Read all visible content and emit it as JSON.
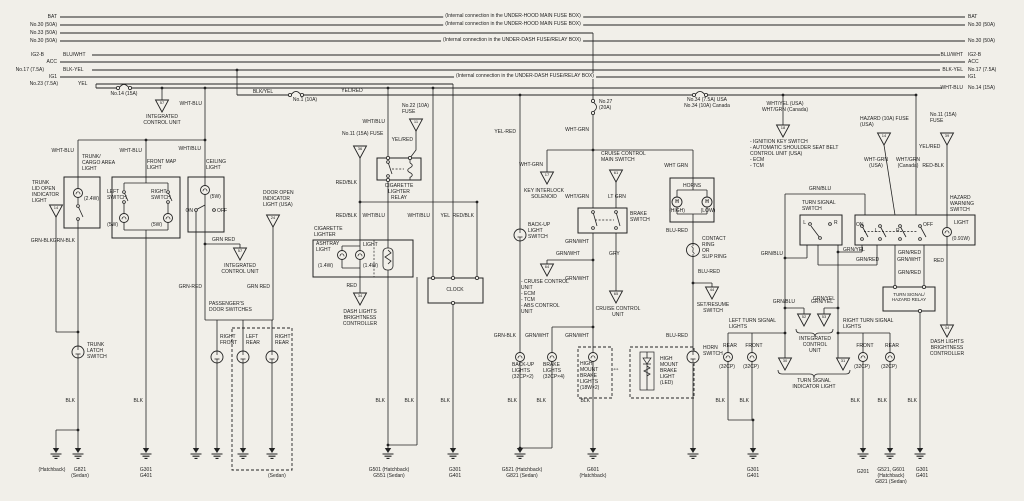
{
  "page": {
    "background_color": "#f1efe9",
    "line_color": "#232323"
  },
  "bus_left": {
    "bat": "BAT",
    "no30a": "No.30 (50A)",
    "no33": "No.33 (50A)",
    "no30b": "No.30 (50A)",
    "ig2b": "IG2-B",
    "ig2b_color": "BLU/WHT",
    "acc": "ACC",
    "no17": "No.17 (7.5A)",
    "no17_color": "BLK-YEL",
    "ig1": "IG1",
    "no23": "No.23 (7.5A)",
    "no23_color": "YEL"
  },
  "bus_right": {
    "bat": "BAT",
    "no30a": "No.30 (50A)",
    "no30b": "No.30 (50A)",
    "ig2b_color": "BLU/WHT",
    "ig2b": "IG2-B",
    "acc": "ACC",
    "no17_color": "BLK-YEL",
    "no17": "No.17 (7.5A)",
    "ig1": "IG1",
    "no14_color": "WHT-BLU",
    "no14": "No.14 (15A)"
  },
  "notes": {
    "underhood": "(Internal connection in the UNDER-HOOD MAIN FUSE BOX)",
    "underdash": "(Internal connection in the UNDER-DASH FUSE/RELAY BOX)"
  },
  "fuses": {
    "no14": "No.14 (15A)",
    "no1": "No.1 (10A)",
    "no22": "No.22 (10A)\nFUSE",
    "no27": "No.27\n(20A)",
    "no34": "No.34 (7.5A) USA\nNo.34 (10A) Canada",
    "no11_left": "No.11 (15A) FUSE",
    "no11_right": "No.11 (15A)\nFUSE",
    "hazard": "HAZARD (10A) FUSE\n(USA)"
  },
  "wires": {
    "whtblu": "WHT-BLU",
    "whtblu_s": "WHT/BLU",
    "blkyel": "BLK/YEL",
    "yelred_s": "YEL/RED",
    "yelred_d": "YEL-RED",
    "redblk_s": "RED/BLK",
    "redblk_d": "RED-BLK",
    "grnblk": "GRN-BLK",
    "grnred_d": "GRN-RED",
    "grnred_sp": "GRN RED",
    "whtgrn_d": "WHT-GRN",
    "whtgrn_s": "WHT/GRN",
    "whtgrn_sp": "WHT GRN",
    "ltgrn": "LT GRN",
    "grnwht": "GRN/WHT",
    "gry": "GRY",
    "grnblu": "GRN/BLU",
    "grnyel": "GRN/YEL",
    "grnred": "GRN/RED",
    "blured": "BLU-RED",
    "red": "RED",
    "yel": "YEL",
    "blk": "BLK",
    "whtyel_both": "WHT/YEL (USA)\nWHT/GRN (Canada)",
    "whtgrn_usa": "WHT-GRN\n(USA)",
    "whtgrn_can": "WHT/GRN\n(Canada)"
  },
  "components": {
    "icu2": "INTEGRATED\nCONTROL UNIT",
    "icu3": "INTEGRATED\nCONTROL\nUNIT",
    "trunk_light": "TRUNK/\nCARGO AREA\nLIGHT",
    "trunk_lid": "TRUNK\nLID OPEN\nINDICATOR\nLIGHT",
    "front_map": "FRONT MAP\nLIGHT",
    "left_switch": "LEFT\nSWITCH",
    "right_switch": "RIGHT\nSWITCH",
    "ceiling": "CEILING\nLIGHT",
    "door_open": "DOOR OPEN\nINDICATOR\nLIGHT (USA)",
    "pass_door": "PASSENGER'S\nDOOR SWITCHES",
    "right_front": "RIGHT\nFRONT",
    "left_rear": "LEFT\nREAR",
    "right_rear": "RIGHT\nREAR",
    "trunk_latch": "TRUNK\nLATCH\nSWITCH",
    "cig_relay": "CIGARETTE\nLIGHTER\nRELAY",
    "cig_lighter": "CIGARETTE\nLIGHTER",
    "ashtray": "ASHTRAY\nLIGHT",
    "light": "LIGHT",
    "dash_brightness": "DASH LIGHTS\nBRIGHTNESS\nCONTROLLER",
    "clock": "CLOCK",
    "backup_switch": "BACK-UP\nLIGHT\nSWITCH",
    "backup_lights": "BACK-UP\nLIGHTS\n(32CP×2)",
    "key_interlock": "KEY INTERLOCK\nSOLENOID",
    "cruise_main": "CRUISE CONTROL\nMAIN SWITCH",
    "brake_switch": "BRAKE\nSWITCH",
    "cruise_unit": "CRUISE CONTROL\nUNIT",
    "cruise_list": "- CRUISE CONTROL\n  UNIT\n- ECM\n- TCM\n- ABS CONTROL\n  UNIT",
    "brake_lights": "BRAKE\nLIGHTS\n(32CP×4)",
    "high_mount": "HIGH\nMOUNT\nBRAKE\nLIGHTS\n(18W×2)",
    "high_mount_led": "HIGH\nMOUNT\nBRAKE\nLIGHT\n(LED)",
    "horns": "HORNS",
    "high": "(HIGH)",
    "low": "(LOW)",
    "h": "H",
    "contact_ring": "CONTACT\nRING\nOR\nSLIP RING",
    "set_resume": "SET/RESUME\nSWITCH",
    "horn_switch": "HORN\nSWITCH",
    "ign_list": "- IGNITION KEY SWITCH\n- AUTOMATIC SHOULDER SEAT BELT\n  CONTROL UNIT (USA)\n- ECM\n- TCM",
    "turn_switch": "TURN SIGNAL\nSWITCH",
    "hazard_switch": "HAZARD\nWARNING\nSWITCH",
    "w091": "(0.91W)",
    "ts_relay": "TURN SIGNAL/\nHAZARD RELAY",
    "tsi": "TURN SIGNAL\nINDICATOR LIGHT",
    "left_turn": "LEFT TURN SIGNAL\nLIGHTS",
    "right_turn": "RIGHT TURN SIGNAL\nLIGHTS",
    "rear": "REAR",
    "front": "FRONT",
    "cp32": "(32CP)",
    "w24": "(2.4W)",
    "w5": "(5W)",
    "w14": "(1.4W)",
    "on": "ON",
    "off": "OFF",
    "l": "L",
    "r": "R",
    "arrows": "⇔"
  },
  "grounds": {
    "hatchback": "(Hatchback)",
    "g821": "G821\n(Sedan)",
    "g301": "G301\nG401",
    "sedan": "(Sedan)",
    "g501": "G501 (Hatchback)\nG551 (Sedan)",
    "g521": "G521 (Hatchback)\nG821 (Sedan)",
    "g601": "G601\n(Hatchback)",
    "g201": "G201",
    "g521b": "G521, G601\n(Hatchback)\nG821 (Sedan)"
  },
  "triangles": {
    "a57": "57",
    "a14": "14",
    "a24": "24",
    "a36": "36",
    "a34": "34",
    "a11": "11",
    "a17": "17",
    "a61": "61",
    "a64": "64",
    "a65": "65",
    "a44": "44",
    "a18": "18",
    "a39": "39",
    "a52": "52",
    "a53": "53",
    "a30": "30",
    "a31": "31"
  }
}
